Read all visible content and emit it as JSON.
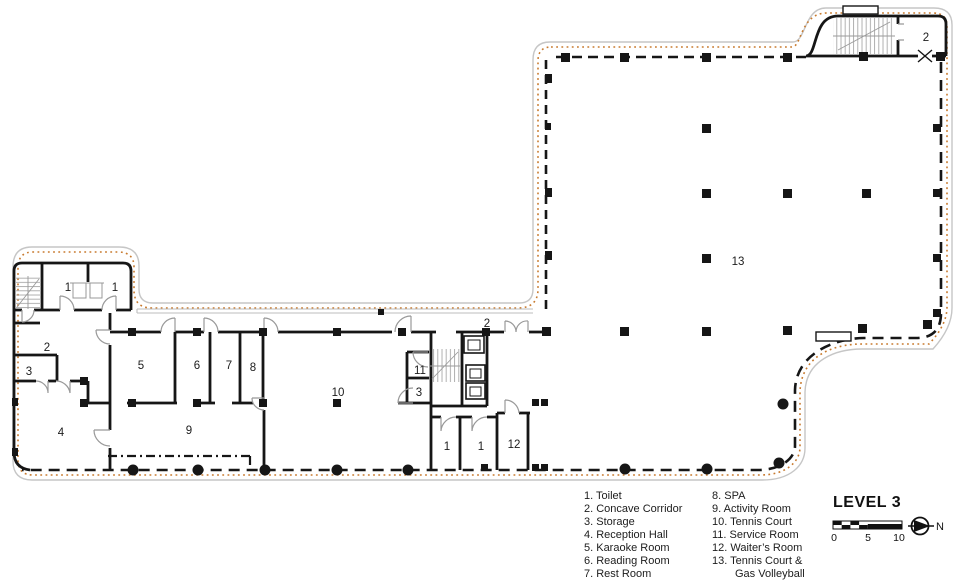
{
  "title": "LEVEL 3",
  "rooms": [
    {
      "label": "1",
      "name": "Toilet"
    },
    {
      "label": "1",
      "name": "Toilet"
    },
    {
      "label": "2",
      "name": "Concave Corridor"
    },
    {
      "label": "3",
      "name": "Storage"
    },
    {
      "label": "4",
      "name": "Reception Hall"
    },
    {
      "label": "5",
      "name": "Karaoke Room"
    },
    {
      "label": "6",
      "name": "Reading Room"
    },
    {
      "label": "7",
      "name": "Rest Room"
    },
    {
      "label": "8",
      "name": "SPA"
    },
    {
      "label": "9",
      "name": "Activity Room"
    },
    {
      "label": "10",
      "name": "Tennis Court"
    },
    {
      "label": "11",
      "name": "Service Room"
    },
    {
      "label": "3",
      "name": "Storage"
    },
    {
      "label": "2",
      "name": "Concave Corridor"
    },
    {
      "label": "1",
      "name": "Toilet"
    },
    {
      "label": "1",
      "name": "Toilet"
    },
    {
      "label": "12",
      "name": "Waiter's Room"
    },
    {
      "label": "13",
      "name": "Tennis Court & Gas Volleyball"
    },
    {
      "label": "2",
      "name": "Concave Corridor"
    }
  ],
  "legend": {
    "column1": [
      {
        "text": "1. Toilet"
      },
      {
        "text": "2. Concave Corridor"
      },
      {
        "text": "3. Storage"
      },
      {
        "text": "4. Reception Hall"
      },
      {
        "text": "5. Karaoke Room"
      },
      {
        "text": "6. Reading Room"
      },
      {
        "text": "7. Rest Room"
      }
    ],
    "column2": [
      {
        "text": "8. SPA"
      },
      {
        "text": "9. Activity Room"
      },
      {
        "text": "10. Tennis Court"
      },
      {
        "text": "11. Service Room"
      },
      {
        "text": "12. Waiter’s Room"
      },
      {
        "text": "13. Tennis Court &"
      },
      {
        "text": "Gas Volleyball",
        "indent": true
      }
    ]
  },
  "scalebar": {
    "ticks": [
      "0",
      "5",
      "10"
    ]
  },
  "north": {
    "label": "N"
  },
  "colors": {
    "wall": "#161616",
    "outline": "#c6c6c6",
    "perimeter_dots": "#c87a2e",
    "door": "#999999"
  }
}
